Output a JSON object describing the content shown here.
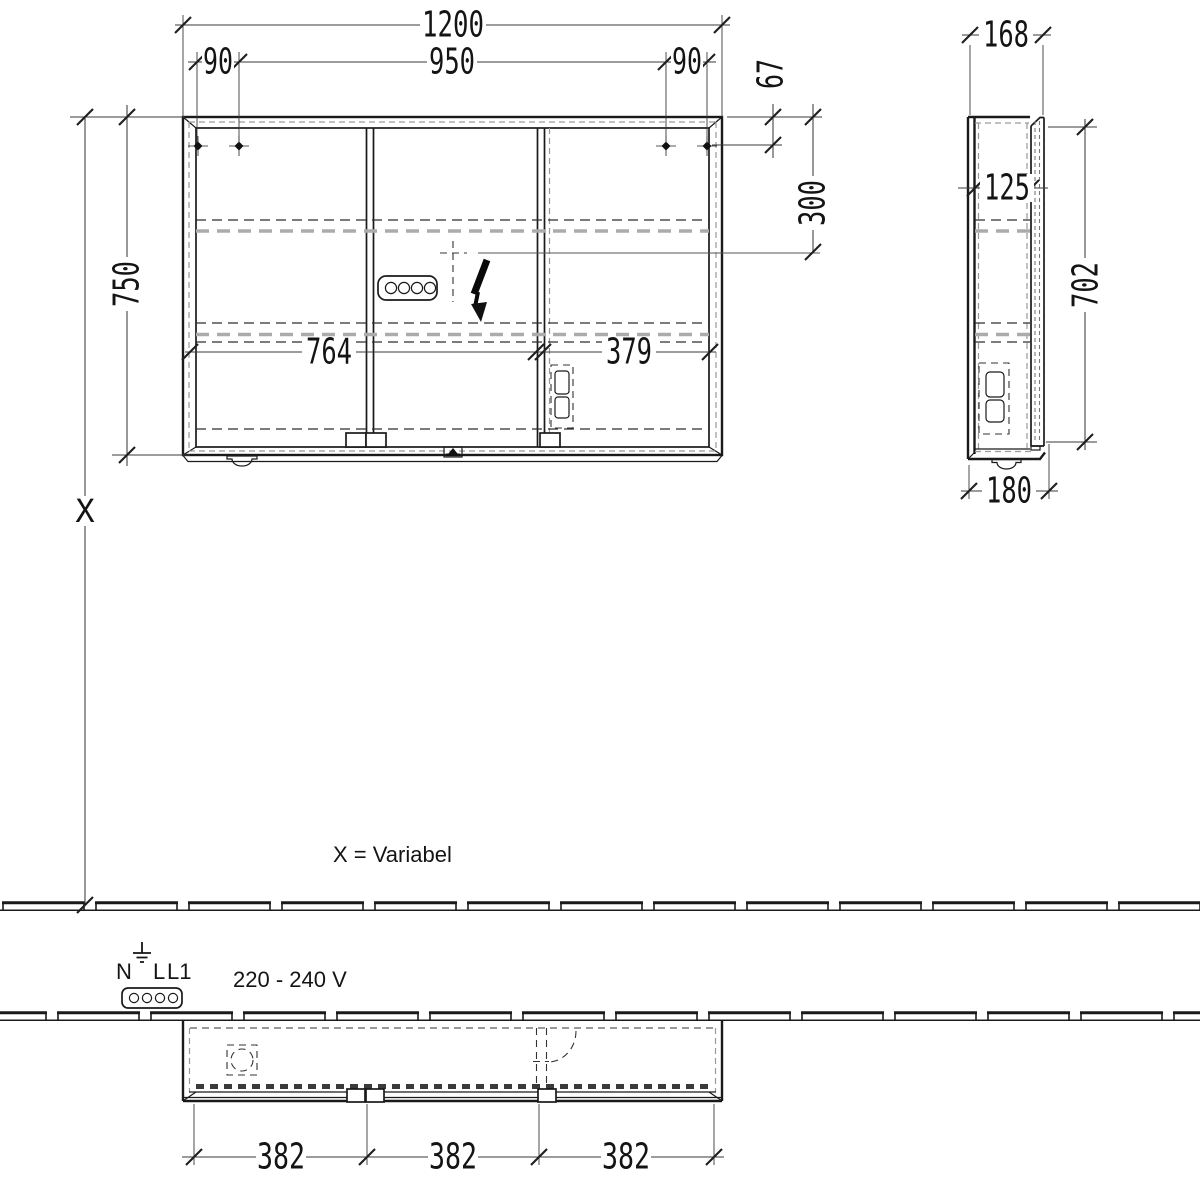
{
  "dims": {
    "front": {
      "total_width": "1200",
      "screw_left": "90",
      "screw_span": "950",
      "screw_right": "90",
      "height": "750",
      "top_to_screws": "67",
      "top_to_outlet": "300",
      "left_section": "764",
      "right_section": "379"
    },
    "side": {
      "total_depth": "168",
      "inner_depth": "125",
      "door_height": "702",
      "bottom_depth": "180"
    },
    "plan": {
      "door_1": "382",
      "door_2": "382",
      "door_3": "382"
    }
  },
  "labels": {
    "x_symbol": "X",
    "x_note": "X = Variabel",
    "voltage": "220 - 240 V",
    "terminal_n": "N",
    "terminal_l": "L",
    "terminal_l1": "L1"
  },
  "icons": {
    "outlet_connector": "plug-connector-icon",
    "power_flash": "lightning-bolt-icon",
    "earth": "ground-icon",
    "mounting_hole": "mounting-hole-icon"
  },
  "colors": {
    "line": "#1a1a1a",
    "dimension": "#3a3a3a",
    "hidden_gray": "#ababab",
    "background": "#ffffff"
  }
}
